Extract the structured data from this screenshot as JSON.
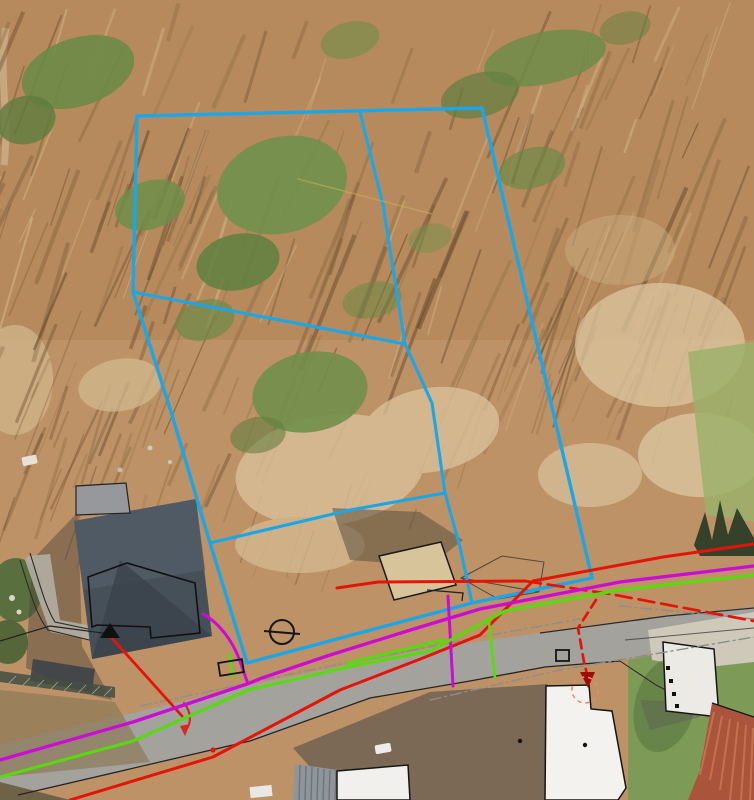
{
  "canvas": {
    "width": 754,
    "height": 800
  },
  "map": {
    "layer_colors": {
      "parcel_boundary": "#1ba6e8",
      "utility_red": "#e41408",
      "utility_magenta": "#cb0cd4",
      "utility_green": "#55de06",
      "road_dashdot_gray": "#8d8d8d",
      "contour_yellow": "#c9b455"
    },
    "features": [
      {
        "name": "parcel-boundary",
        "color": "#1ba6e8",
        "width": 3.4,
        "path": "M137,116 L482,108 L592,578 L472,603 L247,663 L210,543 L172,415 L133,292 Z"
      },
      {
        "name": "parcel-inner-line-vertical",
        "color": "#1ba6e8",
        "width": 3.1,
        "path": "M360,112 L383,205 L405,344 L432,403 L445,493 L460,547 L472,603"
      },
      {
        "name": "parcel-inner-line-diagonal",
        "color": "#1ba6e8",
        "width": 3.1,
        "path": "M133,292 L405,344"
      },
      {
        "name": "parcel-inner-line-horizontal",
        "color": "#1ba6e8",
        "width": 3.1,
        "path": "M210,543 L350,510 L445,493"
      },
      {
        "name": "contour-line-faint-yellow",
        "color": "#c9b455",
        "width": 1.6,
        "opacity": 0.5,
        "path": "M298,179 L432,214"
      },
      {
        "name": "road-centerline-dashdot-west",
        "color": "#8d8d8d",
        "width": 1.4,
        "dash": "11 4 2 4",
        "path": "M140,706 L300,672 L480,637 L580,619"
      },
      {
        "name": "road-centerline-dashdot-east",
        "color": "#8d8d8d",
        "width": 1.4,
        "dash": "11 4 2 4",
        "path": "M430,700 L560,670 L754,637"
      },
      {
        "name": "road-edge-dashdot-northeast",
        "color": "#8d8d8d",
        "width": 1.4,
        "dash": "11 4 2 4",
        "path": "M620,606 L754,619"
      },
      {
        "name": "utility-red-south-line",
        "color": "#e41408",
        "width": 3,
        "path": "M70,800 L213,757 L340,690 L423,658 L480,635 L533,581 L663,557 L754,544"
      },
      {
        "name": "utility-red-north-line",
        "color": "#e41408",
        "width": 3,
        "path": "M337,588 L378,582 L525,581"
      },
      {
        "name": "utility-red-east-dashed",
        "color": "#e41408",
        "width": 2.7,
        "dash": "16 7",
        "path": "M525,581 L610,594 L754,621"
      },
      {
        "name": "utility-red-house-service",
        "color": "#e41408",
        "width": 2.8,
        "path": "M110,636 L182,716"
      },
      {
        "name": "red-road-arrow-curve",
        "color": "#d8281a",
        "width": 2.2,
        "path": "M184,703 C191,712 192,722 186,730"
      },
      {
        "name": "utility-red-drop-dashed",
        "color": "#e01505",
        "width": 2.7,
        "dash": "9 6",
        "path": "M596,600 L578,628 L584,662 L587,674"
      },
      {
        "name": "utility-magenta-main",
        "color": "#cb0cd4",
        "width": 3.3,
        "path": "M0,760 L133,722 L247,684 L262,678 L330,655 L417,628 L480,609 L620,582 L754,566"
      },
      {
        "name": "utility-magenta-house-branch",
        "color": "#cb0cd4",
        "width": 3,
        "path": "M203,614 C218,622 231,639 238,656 L247,681"
      },
      {
        "name": "utility-magenta-south-branch",
        "color": "#cb0cd4",
        "width": 3,
        "path": "M448,596 L453,686"
      },
      {
        "name": "utility-green-main",
        "color": "#55de06",
        "width": 3,
        "path": "M0,777 L133,741 L248,690 L348,667 L430,651 L505,611 L620,590 L754,575"
      },
      {
        "name": "utility-green-parallel-segment",
        "color": "#55de06",
        "width": 3,
        "path": "M348,663 L443,640"
      },
      {
        "name": "utility-green-south-branch",
        "color": "#55de06",
        "width": 2.6,
        "path": "M489,622 L495,678"
      },
      {
        "name": "utility-green-cabinet-stub",
        "color": "#55de06",
        "width": 2.6,
        "path": "M229,654 L233,677"
      }
    ],
    "symbols": [
      {
        "name": "pole-symbol-circle",
        "type": "circle",
        "cx": 282,
        "cy": 632,
        "r": 12,
        "stroke": "#161616",
        "width": 2
      },
      {
        "name": "pole-symbol-crossline",
        "type": "line",
        "x1": 264,
        "y1": 631,
        "x2": 300,
        "y2": 634,
        "stroke": "#161616",
        "width": 2
      },
      {
        "name": "survey-triangle-marker",
        "type": "polygon",
        "points": "110,623 100,638 120,638",
        "fill": "#101010"
      },
      {
        "name": "manhole-square-symbol",
        "type": "rect",
        "x": 556,
        "y": 650,
        "w": 13,
        "h": 11,
        "stroke": "#141414",
        "width": 1.8
      },
      {
        "name": "utility-cabinet-box",
        "type": "rect",
        "x": 219,
        "y": 661,
        "w": 24,
        "h": 13,
        "stroke": "#141414",
        "width": 1.8,
        "rotate": "-9 231 667"
      },
      {
        "name": "red-drop-arrowhead",
        "type": "polygon",
        "points": "580,672 595,672 588,688",
        "fill": "#9b0f06"
      },
      {
        "name": "red-drop-dashed-circle",
        "type": "circle",
        "cx": 585,
        "cy": 690,
        "r": 13,
        "stroke": "#ea8576",
        "width": 1.6,
        "dash": "4 4"
      },
      {
        "name": "road-arrowhead",
        "type": "polygon",
        "points": "180,726 190,724 185,736",
        "fill": "#d8281a"
      },
      {
        "name": "red-point-marker",
        "type": "circle",
        "cx": 213,
        "cy": 750,
        "r": 2.6,
        "fill": "#e41408"
      },
      {
        "name": "building-point-dot",
        "type": "circle",
        "cx": 585,
        "cy": 745,
        "r": 2.2,
        "fill": "#141414"
      },
      {
        "name": "road-point-dot",
        "type": "circle",
        "cx": 520,
        "cy": 741,
        "r": 2.2,
        "fill": "#141414"
      }
    ]
  }
}
